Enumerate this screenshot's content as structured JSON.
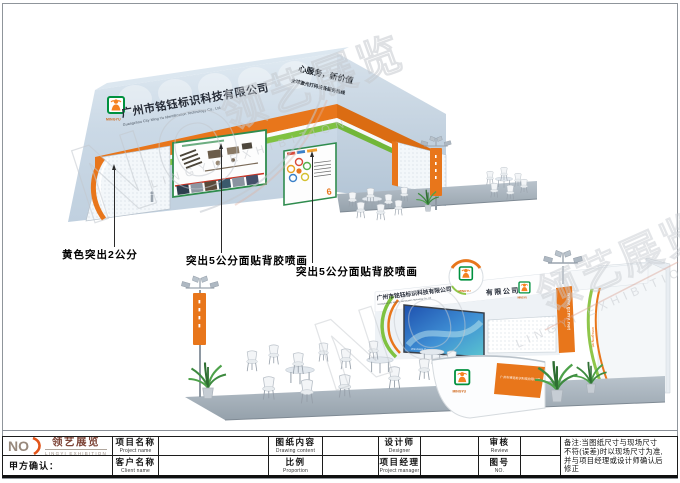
{
  "annotations": {
    "label1": "黄色突出2公分",
    "label2": "突出5公分面贴背胶喷画",
    "label3": "突出5公分面贴背胶喷画"
  },
  "booth": {
    "company_cn": "广州市铭钰标识科技有限公司",
    "company_en": "Guangzhou City Ming Yu Identification Technology Co., Ltd",
    "company_short": "有限公司",
    "slogan_line1": "心服务，新价值",
    "slogan_line2": "全球激光打码设备服务热线",
    "logo_text": "MINGYU",
    "website": "www.gzmy.net",
    "screen_label": "Windows 7"
  },
  "watermark": {
    "no": "NO",
    "cn": "领艺展览",
    "en": "LINGYI EXHIBITION"
  },
  "brand": {
    "no": "NO",
    "cn": "领艺展览",
    "en": "LINGYI EXHIBITION"
  },
  "titleblock": {
    "confirm": "甲方确认：",
    "fields": [
      {
        "cn": "项目名称",
        "en": "Project name"
      },
      {
        "cn": "图纸内容",
        "en": "Drawing content"
      },
      {
        "cn": "设计师",
        "en": "Designer"
      },
      {
        "cn": "审核",
        "en": "Review"
      },
      {
        "cn": "客户名称",
        "en": "Client name"
      },
      {
        "cn": "比例",
        "en": "Proportion"
      },
      {
        "cn": "项目经理",
        "en": "Project manager"
      },
      {
        "cn": "图号",
        "en": "NO."
      }
    ],
    "notes_line1": "备注:当图纸尺寸与现场尺寸",
    "notes_line2": "不符(误差)时以现场尺寸为准,",
    "notes_line3": "并与项目经理或设计师确认后",
    "notes_line4": "修正"
  },
  "colors": {
    "orange": "#E8761B",
    "green": "#7FC241",
    "wall_blue": "#C8D6E3",
    "logo_green": "#00913F",
    "brand_brown": "#7D4437"
  }
}
